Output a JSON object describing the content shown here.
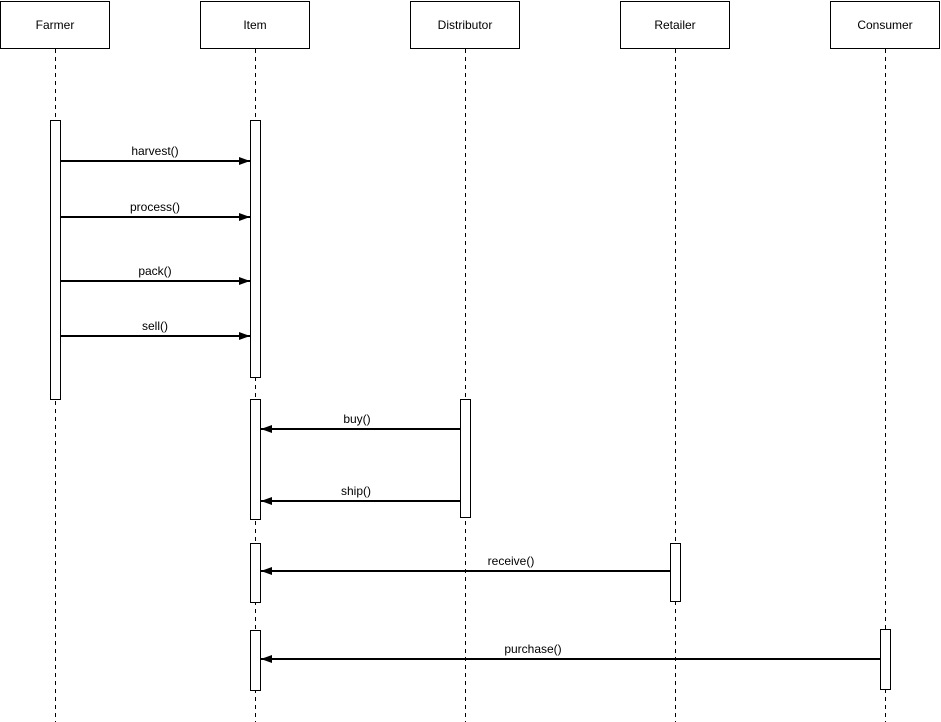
{
  "diagram": {
    "type": "uml-sequence-diagram",
    "background_color": "#ffffff",
    "stroke_color": "#000000",
    "participants": [
      {
        "name": "Farmer",
        "x": 55
      },
      {
        "name": "Item",
        "x": 255
      },
      {
        "name": "Distributor",
        "x": 465
      },
      {
        "name": "Retailer",
        "x": 675
      },
      {
        "name": "Consumer",
        "x": 885
      }
    ],
    "activations": [
      {
        "participant": "Farmer",
        "top": 120,
        "bottom": 400
      },
      {
        "participant": "Item",
        "top": 120,
        "bottom": 378
      },
      {
        "participant": "Item",
        "top": 399,
        "bottom": 520
      },
      {
        "participant": "Distributor",
        "top": 399,
        "bottom": 518
      },
      {
        "participant": "Item",
        "top": 543,
        "bottom": 603
      },
      {
        "participant": "Retailer",
        "top": 543,
        "bottom": 602
      },
      {
        "participant": "Item",
        "top": 630,
        "bottom": 691
      },
      {
        "participant": "Consumer",
        "top": 629,
        "bottom": 690
      }
    ],
    "messages": [
      {
        "label": "harvest()",
        "from": "Farmer",
        "to": "Item",
        "y": 161,
        "label_cx": 155
      },
      {
        "label": "process()",
        "from": "Farmer",
        "to": "Item",
        "y": 217,
        "label_cx": 155
      },
      {
        "label": "pack()",
        "from": "Farmer",
        "to": "Item",
        "y": 281,
        "label_cx": 155
      },
      {
        "label": "sell()",
        "from": "Farmer",
        "to": "Item",
        "y": 336,
        "label_cx": 155
      },
      {
        "label": "buy()",
        "from": "Distributor",
        "to": "Item",
        "y": 429,
        "label_cx": 357
      },
      {
        "label": "ship()",
        "from": "Distributor",
        "to": "Item",
        "y": 501,
        "label_cx": 356
      },
      {
        "label": "receive()",
        "from": "Retailer",
        "to": "Item",
        "y": 571,
        "label_cx": 511
      },
      {
        "label": "purchase()",
        "from": "Consumer",
        "to": "Item",
        "y": 659,
        "label_cx": 533
      }
    ]
  }
}
